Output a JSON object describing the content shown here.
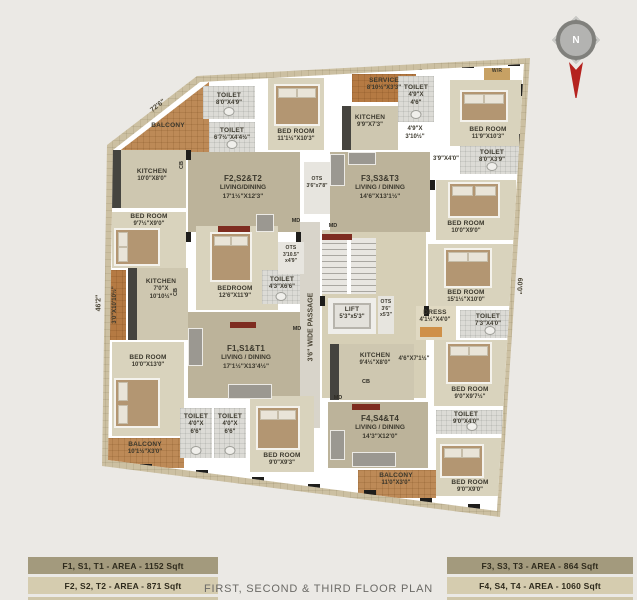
{
  "page_title": "FIRST, SECOND & THIRD FLOOR PLAN",
  "compass": {
    "label": "N"
  },
  "legend": {
    "left": [
      {
        "label": "F1, S1, T1 - AREA - 1152 Sqft"
      },
      {
        "label": "F2, S2, T2 - AREA - 871 Sqft"
      }
    ],
    "right": [
      {
        "label": "F3, S3, T3 - AREA - 864 Sqft"
      },
      {
        "label": "F4, S4, T4 - AREA - 1060 Sqft"
      }
    ]
  },
  "site_dimensions": [
    {
      "text": "72'6\"",
      "x": 158,
      "y": 106,
      "rot": -38
    },
    {
      "text": "46'2\"",
      "x": 99,
      "y": 303,
      "rot": -90
    },
    {
      "text": "60'0\"",
      "x": 519,
      "y": 286,
      "rot": 93
    },
    {
      "text": "3'6\" WIDE PASSAGE",
      "x": 311,
      "y": 327,
      "rot": -90
    }
  ],
  "markers": [
    {
      "text": "MD",
      "x": 296,
      "y": 221
    },
    {
      "text": "MD",
      "x": 333,
      "y": 226
    },
    {
      "text": "MD",
      "x": 297,
      "y": 329
    },
    {
      "text": "MD",
      "x": 338,
      "y": 398
    },
    {
      "text": "CB",
      "x": 366,
      "y": 382
    },
    {
      "text": "CB",
      "x": 182,
      "y": 165,
      "rot": -90
    },
    {
      "text": "CB",
      "x": 176,
      "y": 292,
      "rot": -90
    }
  ],
  "rooms": [
    {
      "type": "hall",
      "x": 322,
      "y": 230,
      "w": 104,
      "h": 168
    },
    {
      "type": "passage",
      "x": 300,
      "y": 222,
      "w": 20,
      "h": 206
    },
    {
      "type": "balcony-tri",
      "name": "BALCONY",
      "x": 113,
      "y": 82,
      "w": 96,
      "h": 74,
      "lx": 168,
      "ly": 122
    },
    {
      "type": "toilet",
      "name": "TOILET",
      "lines": [
        "8'0\"X4'9\""
      ],
      "x": 203,
      "y": 86,
      "w": 52,
      "h": 33,
      "lx": 229,
      "ly": 92
    },
    {
      "type": "toilet",
      "name": "TOILET",
      "lines": [
        "6'7½\"X4'4½\""
      ],
      "x": 209,
      "y": 122,
      "w": 46,
      "h": 30,
      "lx": 232,
      "ly": 127
    },
    {
      "type": "bedroom",
      "name": "BED ROOM",
      "lines": [
        "11'1½\"X10'3\""
      ],
      "x": 268,
      "y": 78,
      "w": 56,
      "h": 72,
      "lx": 296,
      "ly": 128
    },
    {
      "type": "kitchen",
      "name": "KITCHEN",
      "lines": [
        "10'0\"X8'0\""
      ],
      "x": 112,
      "y": 150,
      "w": 74,
      "h": 58,
      "lx": 152,
      "ly": 168
    },
    {
      "type": "living",
      "name": "F2,S2&T2",
      "lines": [
        "LIVING/DINING",
        "17'1½\"X12'3\""
      ],
      "x": 188,
      "y": 152,
      "w": 112,
      "h": 80,
      "lx": 243,
      "ly": 174
    },
    {
      "type": "bedroom",
      "name": "BED ROOM",
      "lines": [
        "9'7½\"X9'0\""
      ],
      "x": 112,
      "y": 212,
      "w": 74,
      "h": 56,
      "lx": 149,
      "ly": 213
    },
    {
      "type": "service-v",
      "name": "SERVICE",
      "lines": [
        "3'0\"X10'10½\""
      ],
      "x": 98,
      "y": 270,
      "w": 28,
      "h": 70,
      "lx": 112,
      "ly": 305,
      "rot": 1
    },
    {
      "type": "kitchen",
      "name": "KITCHEN",
      "lines": [
        "7'0\"X",
        "10'10½\""
      ],
      "x": 128,
      "y": 268,
      "w": 60,
      "h": 72,
      "lx": 161,
      "ly": 278
    },
    {
      "type": "bedroom",
      "name": "BEDROOM",
      "lines": [
        "12'6\"X11'9\""
      ],
      "x": 196,
      "y": 226,
      "w": 82,
      "h": 84,
      "lx": 235,
      "ly": 285
    },
    {
      "type": "toilet",
      "name": "TOILET",
      "lines": [
        "4'3\"X6'6\""
      ],
      "x": 262,
      "y": 270,
      "w": 38,
      "h": 34,
      "lx": 282,
      "ly": 276
    },
    {
      "type": "living",
      "name": "F1,S1&T1",
      "lines": [
        "LIVING / DINING",
        "17'1½\"X13'4½\""
      ],
      "x": 188,
      "y": 312,
      "w": 112,
      "h": 86,
      "lx": 246,
      "ly": 344
    },
    {
      "type": "bedroom",
      "name": "BED ROOM",
      "lines": [
        "10'0\"X13'0\""
      ],
      "x": 112,
      "y": 342,
      "w": 72,
      "h": 94,
      "lx": 148,
      "ly": 354
    },
    {
      "type": "balcony",
      "name": "BALCONY",
      "lines": [
        "10'1½\"X3'0\""
      ],
      "x": 106,
      "y": 438,
      "w": 78,
      "h": 30,
      "lx": 145,
      "ly": 441
    },
    {
      "type": "toilet",
      "name": "TOILET",
      "lines": [
        "4'0\"X",
        "6'6\""
      ],
      "x": 180,
      "y": 408,
      "w": 32,
      "h": 50,
      "lx": 196,
      "ly": 413
    },
    {
      "type": "toilet",
      "name": "TOILET",
      "lines": [
        "4'0\"X",
        "6'6\""
      ],
      "x": 214,
      "y": 408,
      "w": 32,
      "h": 50,
      "lx": 230,
      "ly": 413
    },
    {
      "type": "bedroom",
      "name": "BED ROOM",
      "lines": [
        "9'0\"X9'3\""
      ],
      "x": 250,
      "y": 396,
      "w": 64,
      "h": 76,
      "lx": 282,
      "ly": 452
    },
    {
      "type": "stair",
      "x": 322,
      "y": 238,
      "w": 54,
      "h": 56
    },
    {
      "type": "lift",
      "name": "LIFT",
      "lines": [
        "5'3\"x5'3\""
      ],
      "x": 328,
      "y": 298,
      "w": 48,
      "h": 36,
      "lx": 352,
      "ly": 306
    },
    {
      "type": "ots",
      "name": "OTS",
      "lines": [
        "3'6\"",
        "x5'3\""
      ],
      "x": 378,
      "y": 296,
      "w": 16,
      "h": 38,
      "lx": 386,
      "ly": 299,
      "tiny": 1
    },
    {
      "type": "ots",
      "name": "OTS",
      "lines": [
        "3'10.5\"",
        "x4'9\""
      ],
      "x": 278,
      "y": 242,
      "w": 26,
      "h": 32,
      "lx": 291,
      "ly": 245,
      "tiny": 1
    },
    {
      "type": "ots",
      "name": "OTS",
      "lines": [
        "3'6\"x7'8\""
      ],
      "x": 304,
      "y": 162,
      "w": 26,
      "h": 52,
      "lx": 317,
      "ly": 176,
      "tiny": 1
    },
    {
      "type": "kitchen",
      "name": "KITCHEN",
      "lines": [
        "9'4½\"X8'0\""
      ],
      "x": 330,
      "y": 344,
      "w": 84,
      "h": 56,
      "lx": 375,
      "ly": 352
    },
    {
      "type": "service",
      "name": "SERVICE",
      "lines": [
        "8'10½\"X3'3\""
      ],
      "x": 352,
      "y": 74,
      "w": 64,
      "h": 28,
      "lx": 384,
      "ly": 77
    },
    {
      "type": "toilet",
      "name": "TOILET",
      "lines": [
        "4'9\"X",
        "4'6\""
      ],
      "x": 398,
      "y": 76,
      "w": 36,
      "h": 46,
      "lx": 416,
      "ly": 84
    },
    {
      "type": "kitchen",
      "name": "KITCHEN",
      "lines": [
        "9'9\"X7'3\""
      ],
      "x": 342,
      "y": 106,
      "w": 56,
      "h": 44,
      "lx": 370,
      "ly": 114
    },
    {
      "type": "note",
      "lines": [
        "4'9\"X",
        "3'10½\""
      ],
      "x": 402,
      "y": 126,
      "w": 28,
      "h": 16,
      "lx": 415,
      "ly": 126
    },
    {
      "type": "wr",
      "name": "W/R",
      "x": 484,
      "y": 68,
      "w": 26,
      "h": 12,
      "lx": 497,
      "ly": 68,
      "tiny": 1
    },
    {
      "type": "bedroom",
      "name": "BED ROOM",
      "lines": [
        "11'9\"X10'3\""
      ],
      "x": 450,
      "y": 80,
      "w": 72,
      "h": 66,
      "lx": 488,
      "ly": 126
    },
    {
      "type": "note",
      "lines": [
        "3'9\"X4'0\""
      ],
      "x": 430,
      "y": 156,
      "w": 34,
      "h": 10,
      "lx": 446,
      "ly": 156
    },
    {
      "type": "toilet",
      "name": "TOILET",
      "lines": [
        "8'0\"X3'9\""
      ],
      "x": 460,
      "y": 146,
      "w": 64,
      "h": 28,
      "lx": 492,
      "ly": 149
    },
    {
      "type": "living",
      "name": "F3,S3&T3",
      "lines": [
        "LIVING / DINING",
        "14'6\"X13'1½\""
      ],
      "x": 330,
      "y": 152,
      "w": 100,
      "h": 80,
      "lx": 380,
      "ly": 174
    },
    {
      "type": "bedroom",
      "name": "BED ROOM",
      "lines": [
        "10'0\"X9'0\""
      ],
      "x": 436,
      "y": 180,
      "w": 80,
      "h": 60,
      "lx": 466,
      "ly": 220
    },
    {
      "type": "bedroom",
      "name": "BED ROOM",
      "lines": [
        "15'1½\"X10'0\""
      ],
      "x": 428,
      "y": 244,
      "w": 88,
      "h": 62,
      "lx": 466,
      "ly": 289
    },
    {
      "type": "dress",
      "name": "DRESS",
      "lines": [
        "4'1½\"X4'0\""
      ],
      "x": 416,
      "y": 306,
      "w": 40,
      "h": 34,
      "lx": 435,
      "ly": 309
    },
    {
      "type": "toilet",
      "name": "TOILET",
      "lines": [
        "7'3\"X4'0\""
      ],
      "x": 460,
      "y": 310,
      "w": 60,
      "h": 28,
      "lx": 488,
      "ly": 313
    },
    {
      "type": "note",
      "lines": [
        "4'6\"X7'1½\""
      ],
      "x": 396,
      "y": 356,
      "w": 38,
      "h": 10,
      "lx": 414,
      "ly": 356
    },
    {
      "type": "living",
      "name": "F4,S4&T4",
      "lines": [
        "LIVING / DINING",
        "14'3\"X12'0\""
      ],
      "x": 328,
      "y": 402,
      "w": 100,
      "h": 66,
      "lx": 380,
      "ly": 414
    },
    {
      "type": "bedroom",
      "name": "BED ROOM",
      "lines": [
        "9'0\"X9'7½\""
      ],
      "x": 434,
      "y": 340,
      "w": 74,
      "h": 66,
      "lx": 470,
      "ly": 386
    },
    {
      "type": "toilet",
      "name": "TOILET",
      "lines": [
        "9'0\"X4'0\""
      ],
      "x": 436,
      "y": 410,
      "w": 72,
      "h": 24,
      "lx": 466,
      "ly": 411
    },
    {
      "type": "bedroom",
      "name": "BED ROOM",
      "lines": [
        "9'0\"X9'0\""
      ],
      "x": 436,
      "y": 438,
      "w": 72,
      "h": 58,
      "lx": 470,
      "ly": 479
    },
    {
      "type": "balcony",
      "name": "BALCONY",
      "lines": [
        "11'0\"X3'0\""
      ],
      "x": 358,
      "y": 470,
      "w": 78,
      "h": 28,
      "lx": 396,
      "ly": 472
    }
  ]
}
